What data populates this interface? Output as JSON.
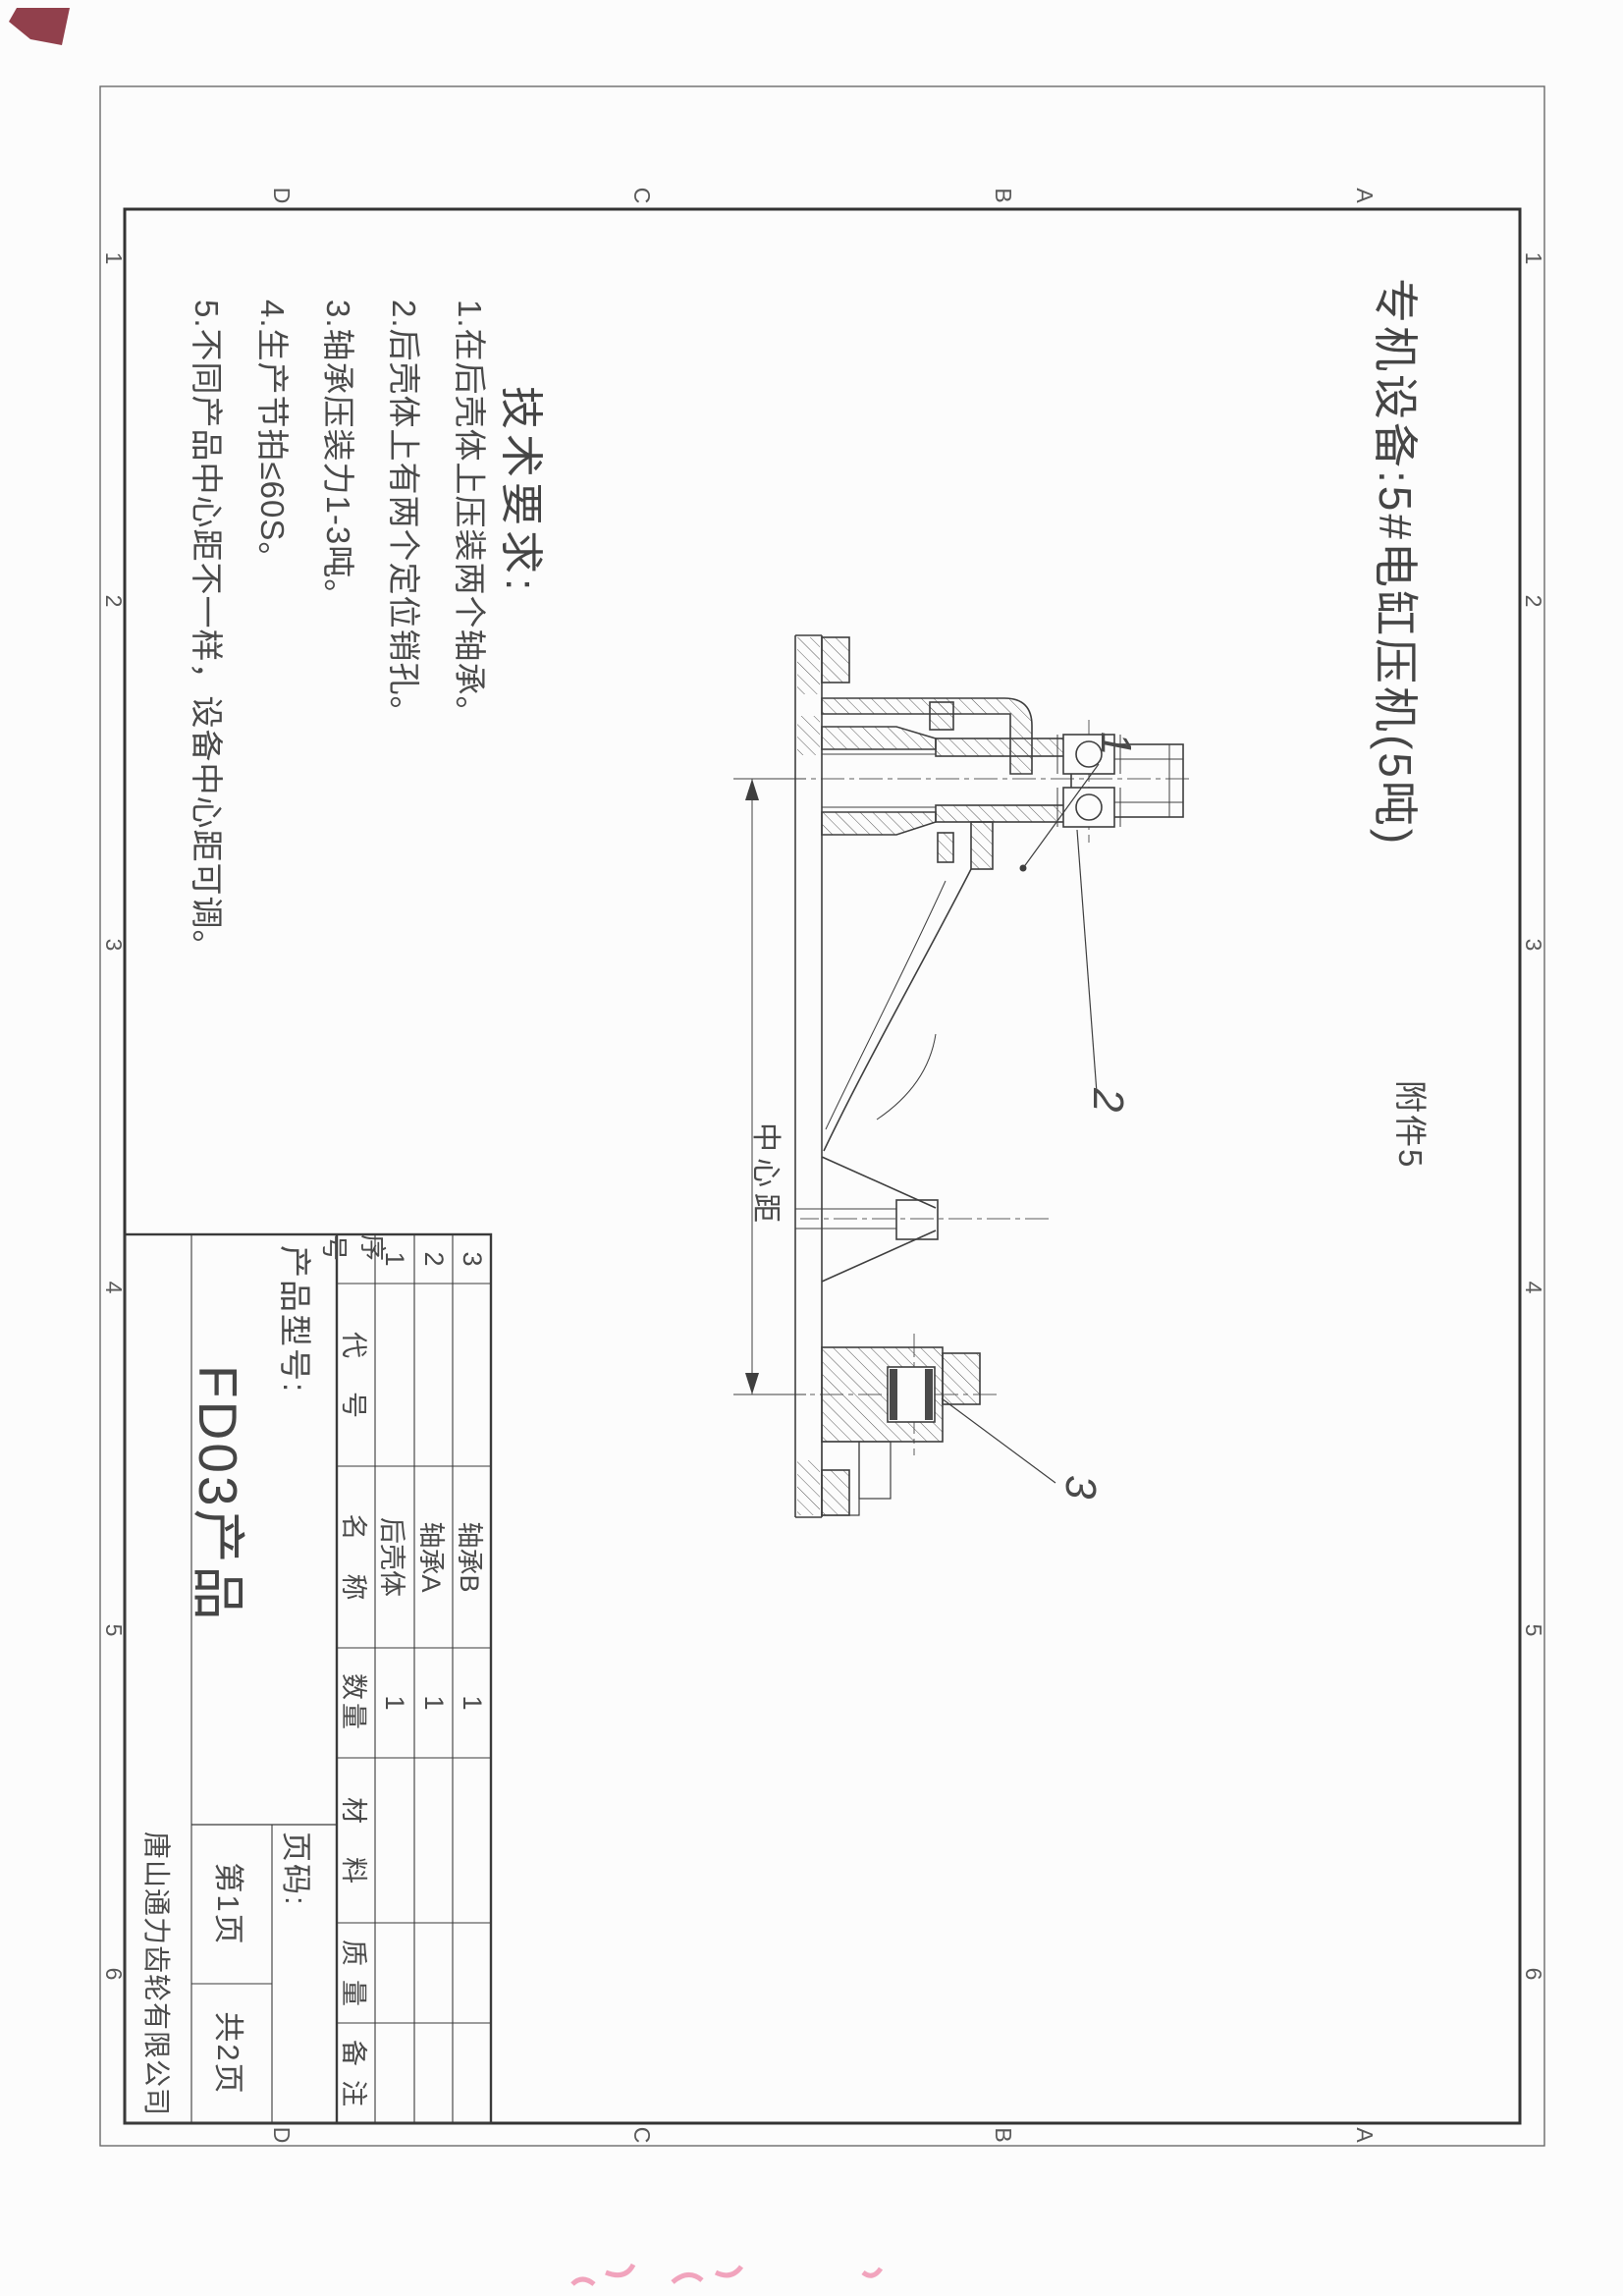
{
  "header": {
    "title": "专机设备:5#电缸压机(5吨)",
    "attachment": "附件5"
  },
  "tech_requirements": {
    "heading": "技术要求:",
    "items": [
      "1.在后壳体上压装两个轴承。",
      "2.后壳体上有两个定位销孔。",
      "3.轴承压装力1-3吨。",
      "4.生产节拍≤60S。",
      "5.不同产品中心距不一样，设备中心距可调。"
    ]
  },
  "drawing": {
    "dimension_label": "中心距",
    "callout_1": "1",
    "callout_2": "2",
    "callout_3": "3"
  },
  "bom": {
    "headers": [
      "序号",
      "代号",
      "名称",
      "数量",
      "材料",
      "质量",
      "备注"
    ],
    "rows": [
      {
        "seq": "3",
        "code": "",
        "name": "轴承B",
        "qty": "1"
      },
      {
        "seq": "2",
        "code": "",
        "name": "轴承A",
        "qty": "1"
      },
      {
        "seq": "1",
        "code": "",
        "name": "后壳体",
        "qty": "1"
      }
    ]
  },
  "title_block": {
    "model_label": "产品型号:",
    "model_value": "FD03产品",
    "page_label": "页码:",
    "page_current": "第1页",
    "page_total": "共2页",
    "company": "唐山通力齿轮有限公司"
  },
  "zones": {
    "numbers": [
      "1",
      "2",
      "3",
      "4",
      "5",
      "6"
    ],
    "letters": [
      "A",
      "B",
      "C",
      "D"
    ]
  },
  "colors": {
    "ink": "#3e3e3e",
    "frame": "#2f2f2f",
    "pink_mark": "#ef8fae"
  }
}
